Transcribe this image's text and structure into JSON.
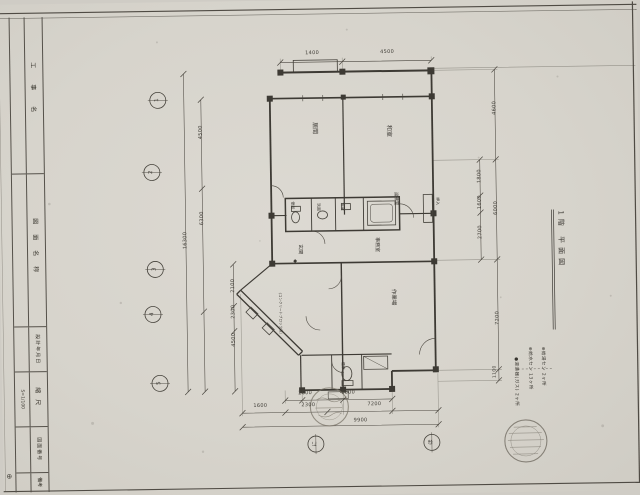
{
  "paper": {
    "background": "#d7d4cc",
    "ink": "#3d3a34"
  },
  "sheet_title": "1階 平面図",
  "title_block": {
    "cells": [
      {
        "label": "工事名",
        "value": ""
      },
      {
        "label": "図面名称",
        "value": ""
      },
      {
        "label": "設計年月日",
        "value": ""
      },
      {
        "label": "縮尺",
        "value": "S=1/100"
      },
      {
        "label": "図面番号",
        "value": ""
      },
      {
        "label": "備考",
        "value": ""
      }
    ],
    "corner_mark": "⊕"
  },
  "rooms": {
    "living": "居間",
    "japanese": "和室",
    "toilet": "便所",
    "washroom": "洗面",
    "bath": "浴室",
    "kitchenette": "湯沸室",
    "office": "事務室",
    "entrance": "玄関",
    "entrance_marker": "◆",
    "workshop": "作業場",
    "closet": "押入",
    "garage_note": "(コンクリートブロック造)",
    "wc_lower": "便所"
  },
  "dims": {
    "top": [
      "1400",
      "4500"
    ],
    "left": [
      "4500",
      "6300",
      "16300",
      "2100",
      "2300",
      "4500"
    ],
    "right": [
      "4600",
      "1800",
      "1600",
      "6000",
      "2700",
      "7200",
      "1100"
    ],
    "bottom": [
      "2600",
      "1800",
      "1600",
      "2300",
      "7200",
      "9900"
    ]
  },
  "grid": {
    "left": [
      "1",
      "2",
      "3",
      "4",
      "5"
    ],
    "bottom": [
      "に",
      "ほ"
    ]
  },
  "legend": {
    "items": [
      {
        "bullet": "⊕",
        "text": "給湯セン 2ヶ所"
      },
      {
        "bullet": "⊕",
        "text": "給水セン 13ヶ所"
      },
      {
        "bullet": "●",
        "text": "湯沸器(ガス) 2ヶ所"
      }
    ]
  }
}
